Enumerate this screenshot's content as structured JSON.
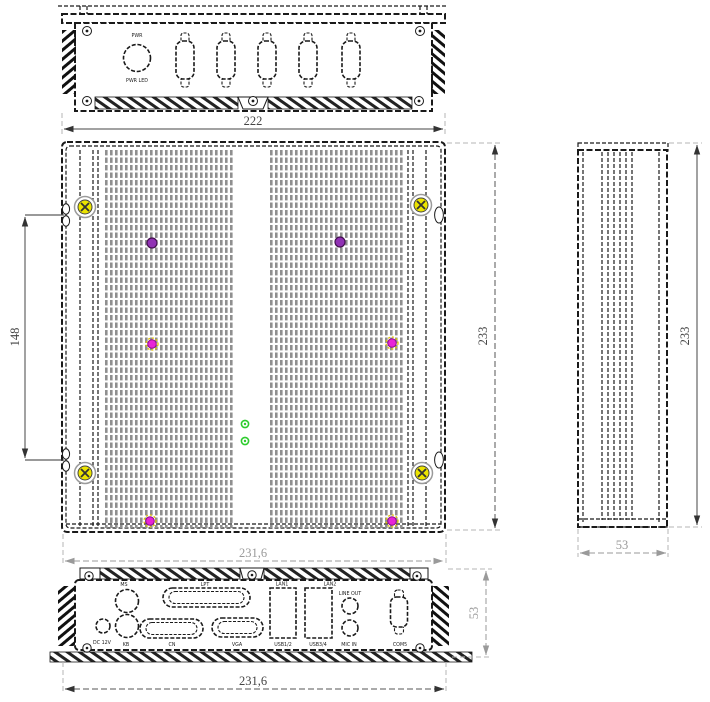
{
  "colors": {
    "line": "#1a1a1a",
    "fin_gray": "#8f8f8f",
    "dim_gray": "#9a9a9a",
    "dim_dark": "#444444",
    "screw_yellow": "#ece400",
    "dot_purple": "#9031b4",
    "dot_magenta": "#e824d8",
    "dot_green": "#2ecc2e"
  },
  "top_view": {
    "pwr_label": "PWR",
    "pwr_led_label": "PWR LED",
    "width_dim": "222"
  },
  "front_view": {
    "mount_dim": "148",
    "height_dim": "233",
    "width_dim": "231,6"
  },
  "side_view": {
    "height_dim": "233",
    "depth_dim": "53"
  },
  "bottom_view": {
    "width_dim": "231,6",
    "depth_dim": "53",
    "ports_top": {
      "ms": "MS",
      "lpt": "LPT",
      "lan1": "LAN1",
      "lan2": "LAN2",
      "line_out": "LINE OUT"
    },
    "ports_bottom": {
      "dc": "DC 12V",
      "kb": "KB",
      "cn": "CN",
      "vga": "VGA",
      "usb12": "USB1/2",
      "usb34": "USB3/4",
      "mic_in": "MIC IN",
      "com5": "COM5"
    }
  }
}
